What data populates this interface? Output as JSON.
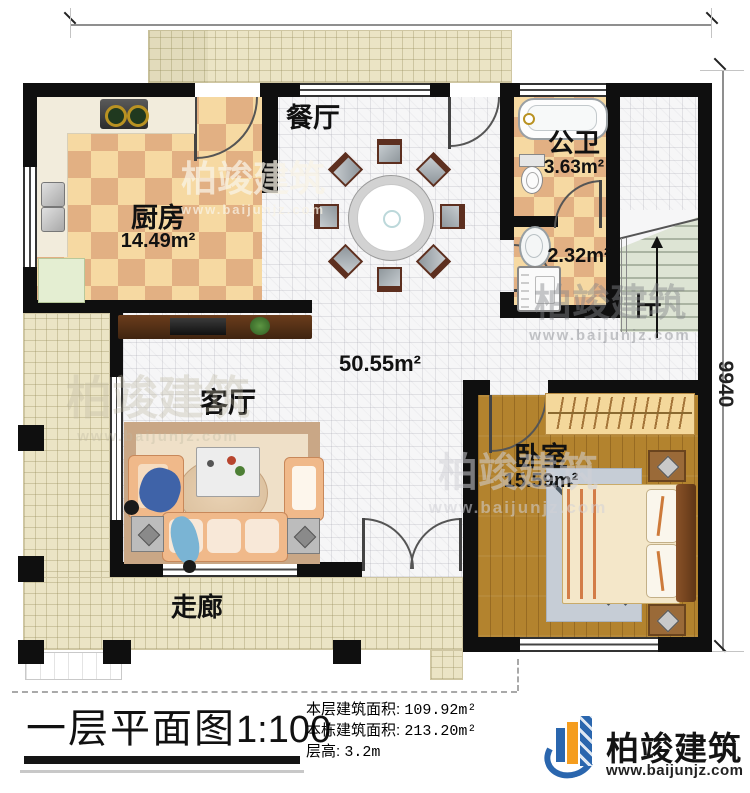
{
  "dims": {
    "top": "11940",
    "right": "9940"
  },
  "rooms": {
    "dining": {
      "name": "餐厅"
    },
    "kitchen": {
      "name": "厨房",
      "area": "14.49m²"
    },
    "bath": {
      "name": "公卫",
      "area": "3.63m²"
    },
    "wash": {
      "area": "2.32m²"
    },
    "hall": {
      "area": "50.55m²"
    },
    "living": {
      "name": "客厅"
    },
    "bedroom": {
      "name": "卧室",
      "area": "15.59m²"
    },
    "corridor": {
      "name": "走廊"
    },
    "stairs": {
      "up_label": "上"
    }
  },
  "footer": {
    "title": "一层平面图",
    "scale": "1:100",
    "stats": [
      {
        "label": "本层建筑面积:",
        "value": "109.92m²"
      },
      {
        "label": "本栋建筑面积:",
        "value": "213.20m²"
      },
      {
        "label": "层高:",
        "value": "3.2m"
      }
    ],
    "brand": {
      "name": "柏竣建筑",
      "site": "www.baijunjz.com"
    }
  },
  "watermark": {
    "text": "柏竣建筑",
    "site": "www.baijunjz.com"
  },
  "colors": {
    "brand_blue": "#2a66ae",
    "brand_orange": "#f59d1e",
    "wall": "#0f0f0f"
  }
}
